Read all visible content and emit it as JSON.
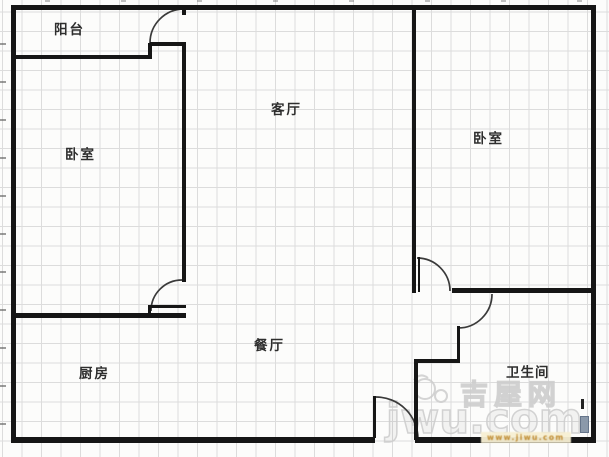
{
  "floorplan": {
    "rooms": {
      "balcony": {
        "label": "阳台"
      },
      "bedroom_left": {
        "label": "卧室"
      },
      "living_room": {
        "label": "客厅"
      },
      "bedroom_right": {
        "label": "卧室"
      },
      "dining_room": {
        "label": "餐厅"
      },
      "kitchen": {
        "label": "厨房"
      },
      "bathroom": {
        "label": "卫生间"
      }
    },
    "watermark": {
      "site_name_cn": "吉屋网",
      "site_name_en": "jwu.com",
      "url_text": "www.jiwu.com"
    },
    "colors": {
      "wall": "#161616",
      "grid_line": "#dcdcdc",
      "paper": "#fcfcfb",
      "watermark_gray": "#cdcdcd",
      "url_orange": "#bf8a2e",
      "fixture_blue": "#8b99aa"
    }
  }
}
